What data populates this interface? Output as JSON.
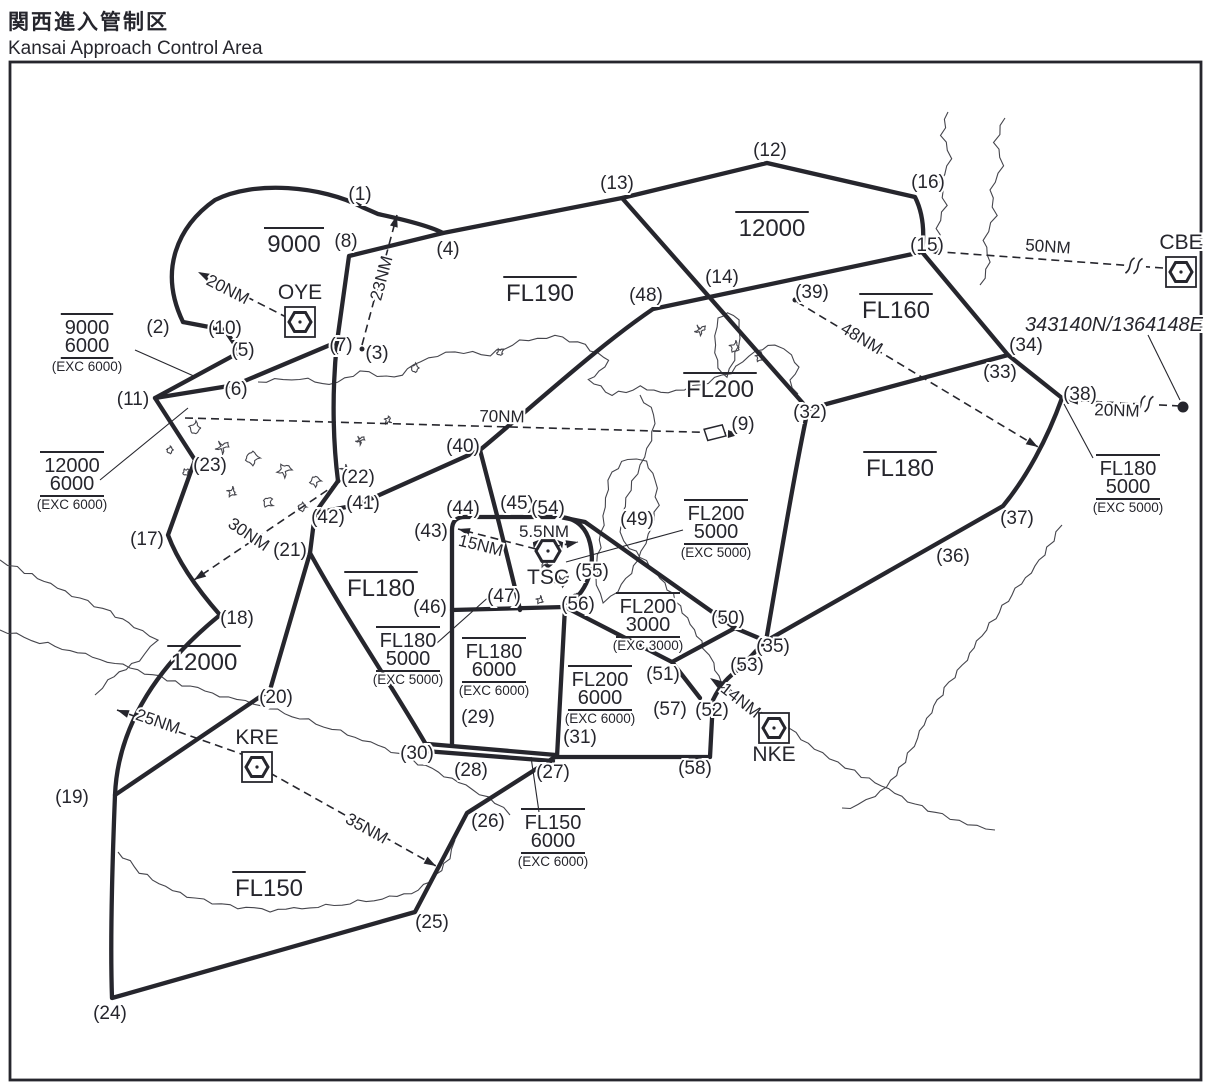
{
  "title": {
    "jp": "関西進入管制区",
    "en": "Kansai Approach Control Area"
  },
  "colors": {
    "ink": "#26262d"
  },
  "points": [
    {
      "n": "(1)",
      "x": 360,
      "y": 194
    },
    {
      "n": "(2)",
      "x": 158,
      "y": 327
    },
    {
      "n": "(3)",
      "x": 377,
      "y": 353
    },
    {
      "n": "(4)",
      "x": 448,
      "y": 249
    },
    {
      "n": "(5)",
      "x": 243,
      "y": 350
    },
    {
      "n": "(6)",
      "x": 236,
      "y": 389
    },
    {
      "n": "(7)",
      "x": 341,
      "y": 345
    },
    {
      "n": "(8)",
      "x": 346,
      "y": 241
    },
    {
      "n": "(9)",
      "x": 743,
      "y": 424
    },
    {
      "n": "(10)",
      "x": 225,
      "y": 328
    },
    {
      "n": "(11)",
      "x": 133,
      "y": 399
    },
    {
      "n": "(12)",
      "x": 770,
      "y": 150
    },
    {
      "n": "(13)",
      "x": 617,
      "y": 183
    },
    {
      "n": "(14)",
      "x": 722,
      "y": 277
    },
    {
      "n": "(15)",
      "x": 927,
      "y": 245
    },
    {
      "n": "(16)",
      "x": 928,
      "y": 182
    },
    {
      "n": "(17)",
      "x": 147,
      "y": 539
    },
    {
      "n": "(18)",
      "x": 237,
      "y": 618
    },
    {
      "n": "(19)",
      "x": 72,
      "y": 797
    },
    {
      "n": "(20)",
      "x": 276,
      "y": 697
    },
    {
      "n": "(21)",
      "x": 290,
      "y": 550
    },
    {
      "n": "(22)",
      "x": 358,
      "y": 477
    },
    {
      "n": "(23)",
      "x": 210,
      "y": 465
    },
    {
      "n": "(24)",
      "x": 110,
      "y": 1013
    },
    {
      "n": "(25)",
      "x": 432,
      "y": 922
    },
    {
      "n": "(26)",
      "x": 488,
      "y": 821
    },
    {
      "n": "(27)",
      "x": 553,
      "y": 772
    },
    {
      "n": "(28)",
      "x": 471,
      "y": 770
    },
    {
      "n": "(29)",
      "x": 478,
      "y": 717
    },
    {
      "n": "(30)",
      "x": 417,
      "y": 753
    },
    {
      "n": "(31)",
      "x": 580,
      "y": 737
    },
    {
      "n": "(32)",
      "x": 810,
      "y": 412
    },
    {
      "n": "(33)",
      "x": 1000,
      "y": 372
    },
    {
      "n": "(34)",
      "x": 1026,
      "y": 345
    },
    {
      "n": "(35)",
      "x": 773,
      "y": 646
    },
    {
      "n": "(36)",
      "x": 953,
      "y": 556
    },
    {
      "n": "(37)",
      "x": 1017,
      "y": 518
    },
    {
      "n": "(38)",
      "x": 1080,
      "y": 394
    },
    {
      "n": "(39)",
      "x": 812,
      "y": 292
    },
    {
      "n": "(40)",
      "x": 463,
      "y": 446
    },
    {
      "n": "(41)",
      "x": 363,
      "y": 503
    },
    {
      "n": "(42)",
      "x": 328,
      "y": 517
    },
    {
      "n": "(43)",
      "x": 431,
      "y": 531
    },
    {
      "n": "(44)",
      "x": 463,
      "y": 508
    },
    {
      "n": "(45)",
      "x": 517,
      "y": 503
    },
    {
      "n": "(46)",
      "x": 430,
      "y": 607
    },
    {
      "n": "(47)",
      "x": 504,
      "y": 596
    },
    {
      "n": "(48)",
      "x": 646,
      "y": 295
    },
    {
      "n": "(49)",
      "x": 637,
      "y": 519
    },
    {
      "n": "(50)",
      "x": 728,
      "y": 618
    },
    {
      "n": "(51)",
      "x": 663,
      "y": 674
    },
    {
      "n": "(52)",
      "x": 712,
      "y": 710
    },
    {
      "n": "(53)",
      "x": 747,
      "y": 665
    },
    {
      "n": "(54)",
      "x": 548,
      "y": 508
    },
    {
      "n": "(55)",
      "x": 592,
      "y": 571
    },
    {
      "n": "(56)",
      "x": 578,
      "y": 604
    },
    {
      "n": "(57)",
      "x": 670,
      "y": 709
    },
    {
      "n": "(58)",
      "x": 695,
      "y": 768
    }
  ],
  "altitude_labels": [
    {
      "text": "9000",
      "x": 294,
      "y": 244
    },
    {
      "text": "12000",
      "x": 772,
      "y": 228
    },
    {
      "text": "FL190",
      "x": 540,
      "y": 293
    },
    {
      "text": "FL160",
      "x": 896,
      "y": 310
    },
    {
      "text": "FL200",
      "x": 720,
      "y": 389
    },
    {
      "text": "FL180",
      "x": 900,
      "y": 468
    },
    {
      "text": "FL180",
      "x": 381,
      "y": 588
    },
    {
      "text": "12000",
      "x": 204,
      "y": 662
    },
    {
      "text": "FL150",
      "x": 269,
      "y": 888
    }
  ],
  "stacked_labels": [
    {
      "top": "9000",
      "bottom": "6000",
      "exc": "(EXC 6000)",
      "x": 87,
      "y": 327
    },
    {
      "top": "12000",
      "bottom": "6000",
      "exc": "(EXC 6000)",
      "x": 72,
      "y": 465
    },
    {
      "top": "FL180",
      "bottom": "5000",
      "exc": "(EXC 5000)",
      "x": 408,
      "y": 640
    },
    {
      "top": "FL180",
      "bottom": "6000",
      "exc": "(EXC 6000)",
      "x": 494,
      "y": 651
    },
    {
      "top": "FL200",
      "bottom": "5000",
      "exc": "(EXC 5000)",
      "x": 716,
      "y": 513
    },
    {
      "top": "FL200",
      "bottom": "3000",
      "exc": "(EXC 3000)",
      "x": 648,
      "y": 606
    },
    {
      "top": "FL200",
      "bottom": "6000",
      "exc": "(EXC 6000)",
      "x": 600,
      "y": 679
    },
    {
      "top": "FL150",
      "bottom": "6000",
      "exc": "(EXC 6000)",
      "x": 553,
      "y": 822
    },
    {
      "top": "FL180",
      "bottom": "5000",
      "exc": "(EXC 5000)",
      "x": 1128,
      "y": 468
    }
  ],
  "navaids": [
    {
      "id": "OYE",
      "x": 300,
      "y": 322,
      "boxed": true,
      "vortac": false,
      "label_side": "above"
    },
    {
      "id": "CBE",
      "x": 1181,
      "y": 272,
      "boxed": true,
      "vortac": false,
      "label_side": "above"
    },
    {
      "id": "TSC",
      "x": 548,
      "y": 551,
      "boxed": false,
      "vortac": true,
      "label_side": "below"
    },
    {
      "id": "KRE",
      "x": 257,
      "y": 767,
      "boxed": true,
      "vortac": false,
      "label_side": "above"
    },
    {
      "id": "NKE",
      "x": 774,
      "y": 728,
      "boxed": true,
      "vortac": false,
      "label_side": "below"
    }
  ],
  "distances": [
    {
      "text": "20NM",
      "x1": 288,
      "y1": 318,
      "x2": 198,
      "y2": 272,
      "lx": 228,
      "ly": 289,
      "rot": 27
    },
    {
      "text": "23NM",
      "x1": 362,
      "y1": 345,
      "x2": 397,
      "y2": 215,
      "lx": 381,
      "ly": 278,
      "rot": -75
    },
    {
      "text": "50NM",
      "x1": 1163,
      "y1": 268,
      "x2": 928,
      "y2": 251,
      "lx": 1048,
      "ly": 246,
      "rot": 4,
      "break_at": [
        1137,
        266
      ]
    },
    {
      "text": "70NM",
      "x1": 185,
      "y1": 418,
      "x2": 728,
      "y2": 433,
      "lx": 502,
      "ly": 416,
      "rot": 1,
      "pennant": true
    },
    {
      "text": "48NM",
      "x1": 797,
      "y1": 302,
      "x2": 1038,
      "y2": 447,
      "lx": 862,
      "ly": 338,
      "rot": 31
    },
    {
      "text": "30NM",
      "x1": 338,
      "y1": 483,
      "x2": 194,
      "y2": 580,
      "lx": 249,
      "ly": 534,
      "rot": 34
    },
    {
      "text": "25NM",
      "x1": 247,
      "y1": 756,
      "x2": 117,
      "y2": 710,
      "lx": 158,
      "ly": 721,
      "rot": 19
    },
    {
      "text": "35NM",
      "x1": 270,
      "y1": 773,
      "x2": 436,
      "y2": 866,
      "lx": 367,
      "ly": 828,
      "rot": 29
    },
    {
      "text": "14NM",
      "x1": 762,
      "y1": 713,
      "x2": 710,
      "y2": 678,
      "lx": 741,
      "ly": 700,
      "rot": 38
    },
    {
      "text": "15NM",
      "x1": 536,
      "y1": 549,
      "x2": 458,
      "y2": 529,
      "lx": 481,
      "ly": 545,
      "rot": 14
    },
    {
      "text": "5.5NM",
      "x1": 552,
      "y1": 547,
      "x2": 578,
      "y2": 542,
      "lx": 544,
      "ly": 531,
      "rot": 0
    },
    {
      "text": "20NM",
      "x1": 1180,
      "y1": 406,
      "x2": 1066,
      "y2": 400,
      "lx": 1117,
      "ly": 410,
      "rot": 2,
      "break_at": [
        1148,
        404
      ]
    }
  ],
  "leaders": [
    {
      "x1": 135,
      "y1": 350,
      "x2": 196,
      "y2": 377
    },
    {
      "x1": 100,
      "y1": 480,
      "x2": 188,
      "y2": 408
    },
    {
      "x1": 437,
      "y1": 643,
      "x2": 492,
      "y2": 594
    },
    {
      "x1": 683,
      "y1": 530,
      "x2": 566,
      "y2": 562
    },
    {
      "x1": 539,
      "y1": 812,
      "x2": 531,
      "y2": 757
    },
    {
      "x1": 1093,
      "y1": 458,
      "x2": 1064,
      "y2": 404
    },
    {
      "x1": 1148,
      "y1": 335,
      "x2": 1180,
      "y2": 400
    }
  ],
  "dots": [
    {
      "x": 362,
      "y": 349,
      "r": 2.5
    },
    {
      "x": 338,
      "y": 481,
      "r": 2.5
    },
    {
      "x": 795,
      "y": 300,
      "r": 2.5
    },
    {
      "x": 1183,
      "y": 407,
      "r": 5.5
    }
  ],
  "coordinate_note": {
    "text": "343140N/1364148E",
    "x": 1114,
    "y": 325
  }
}
